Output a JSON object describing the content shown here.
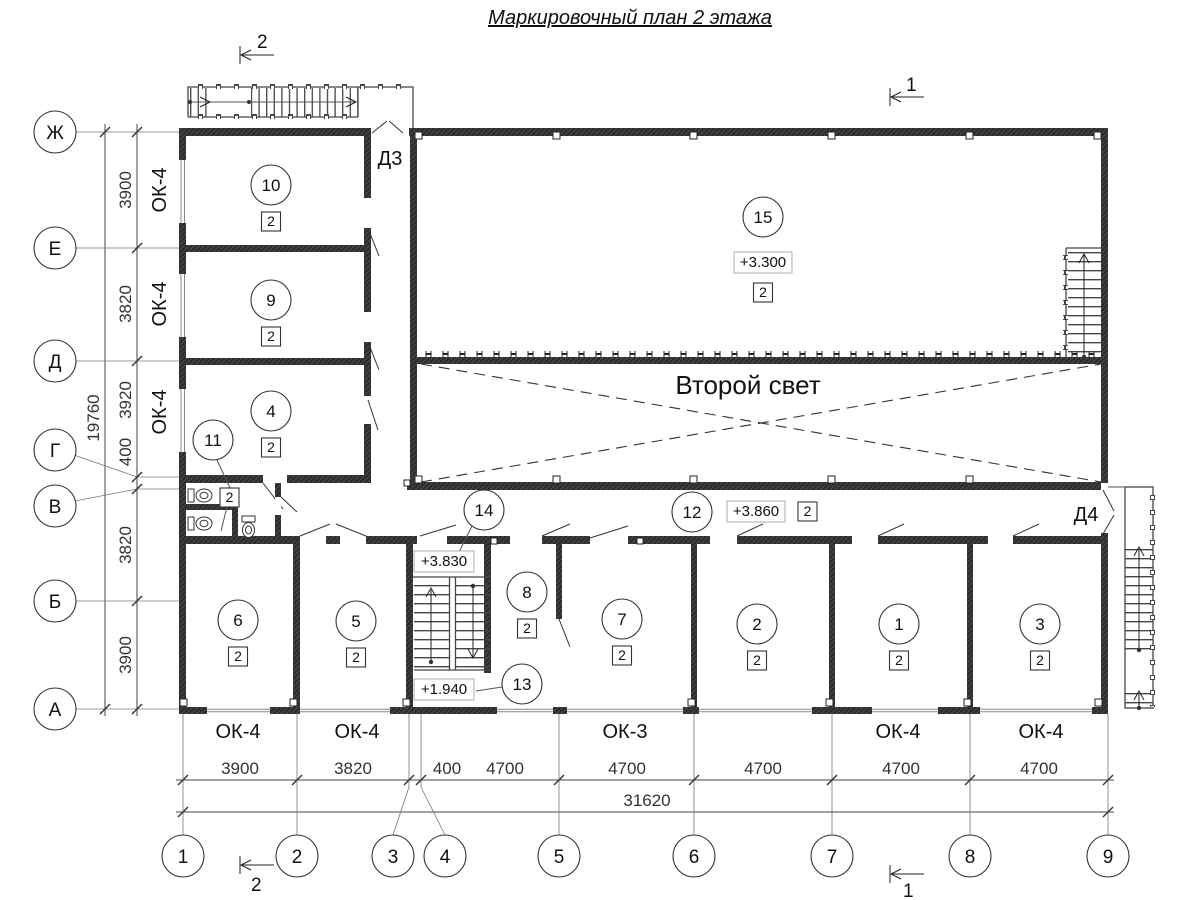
{
  "title": "Маркировочный план 2 этажа",
  "axes": {
    "horizontal": [
      "1",
      "2",
      "3",
      "4",
      "5",
      "6",
      "7",
      "8",
      "9"
    ],
    "vertical": [
      "Ж",
      "Е",
      "Д",
      "Г",
      "В",
      "Б",
      "А"
    ]
  },
  "dimensions": {
    "bottom_segments": [
      "3900",
      "3820",
      "400",
      "4700",
      "4700",
      "4700",
      "4700",
      "4700"
    ],
    "bottom_total": "31620",
    "left_segments": [
      "3900",
      "3820",
      "3920",
      "400",
      "3820",
      "3900"
    ],
    "left_total": "19760"
  },
  "window_marks": {
    "left": [
      "ОК-4",
      "ОК-4",
      "ОК-4"
    ],
    "bottom": [
      "ОК-4",
      "ОК-4",
      "ОК-3",
      "ОК-4",
      "ОК-4"
    ]
  },
  "door_marks": {
    "d3": "Д3",
    "d4": "Д4"
  },
  "section_marks": {
    "top_left": "2",
    "top_right": "1",
    "bottom_left": "2",
    "bottom_right": "1"
  },
  "annotations": {
    "second_light": "Второй свет"
  },
  "elevations": {
    "hall": "+3.300",
    "corridor": "+3.860",
    "stair_upper": "+3.830",
    "stair_lower": "+1.940"
  },
  "rooms": {
    "r10": {
      "number": "10",
      "type": "2"
    },
    "r9": {
      "number": "9",
      "type": "2"
    },
    "r4": {
      "number": "4",
      "type": "2"
    },
    "r11": {
      "number": "11",
      "type": "2"
    },
    "r15": {
      "number": "15",
      "type": "2"
    },
    "r14": {
      "number": "14"
    },
    "r12": {
      "number": "12",
      "type": "2"
    },
    "r13": {
      "number": "13"
    },
    "r8": {
      "number": "8",
      "type": "2"
    },
    "r7": {
      "number": "7",
      "type": "2"
    },
    "r6": {
      "number": "6",
      "type": "2"
    },
    "r5": {
      "number": "5",
      "type": "2"
    },
    "r2": {
      "number": "2",
      "type": "2"
    },
    "r1": {
      "number": "1",
      "type": "2"
    },
    "r3": {
      "number": "3",
      "type": "2"
    }
  }
}
